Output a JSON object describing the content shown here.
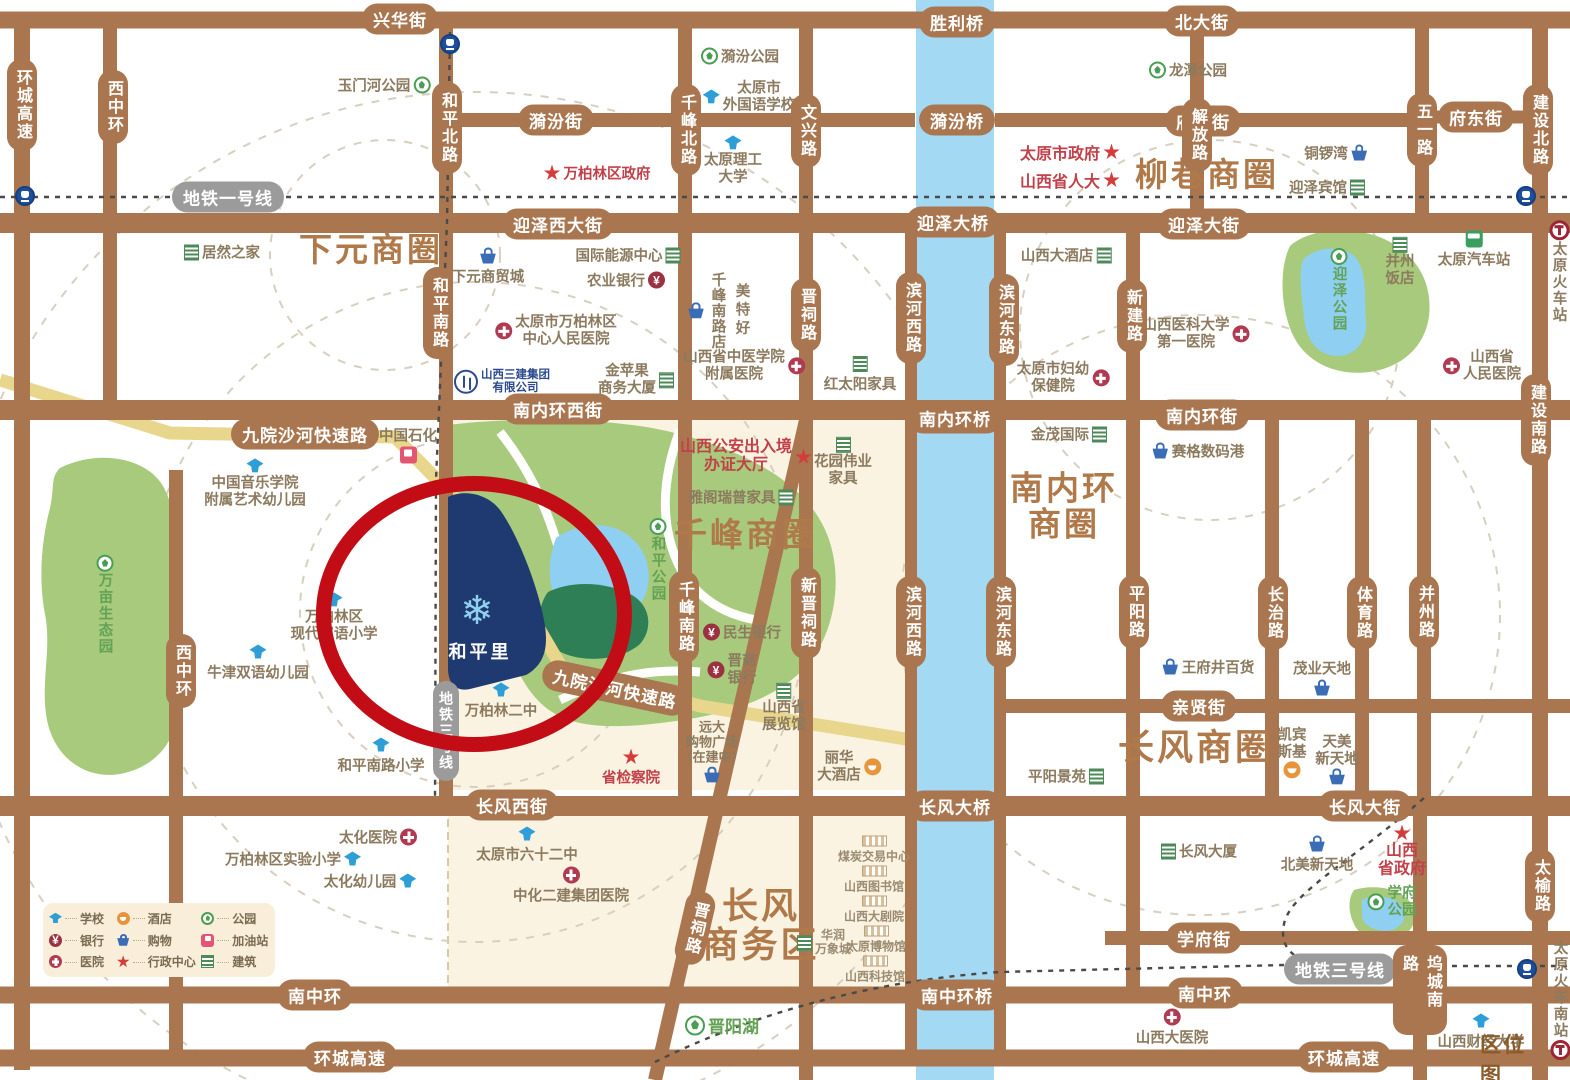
{
  "legend": {
    "items": [
      {
        "icon": "school",
        "label": "学校"
      },
      {
        "icon": "hotel",
        "label": "酒店"
      },
      {
        "icon": "park",
        "label": "公园"
      },
      {
        "icon": "bank",
        "label": "银行"
      },
      {
        "icon": "shop",
        "label": "购物"
      },
      {
        "icon": "gas",
        "label": "加油站"
      },
      {
        "icon": "hospital",
        "label": "医院"
      },
      {
        "icon": "admin",
        "label": "行政中心"
      },
      {
        "icon": "building",
        "label": "建筑"
      }
    ]
  },
  "metro": {
    "line1": "地铁一号线",
    "line3": "地铁三号线",
    "line3_b": "地铁三号线"
  },
  "districts": {
    "xiayuan": "下元商圈",
    "liuxiang": "柳巷商圈",
    "qianfeng": "千峰商圈",
    "nanneihuan_l1": "南内环",
    "nanneihuan_l2": "商圈",
    "changfeng": "长风商圈",
    "changfengbiz_l1": "长风",
    "changfengbiz_l2": "商务区"
  },
  "project": {
    "name": "和平里",
    "logo_icon": "snowflake"
  },
  "corner_tag": "区位图",
  "roads": {
    "xinghua": "兴华街",
    "shengli": "胜利桥",
    "beida": "北大街",
    "yifen": "漪汾街",
    "yifenqiao": "漪汾桥",
    "fuxi": "府西街",
    "fudong": "府东街",
    "yingze_w": "迎泽西大街",
    "yingzeqiao": "迎泽大桥",
    "yingze": "迎泽大街",
    "nnh_w": "南内环西街",
    "nnh_qiao": "南内环桥",
    "nnh": "南内环街",
    "cf_w": "长风西街",
    "cf_qiao": "长风大桥",
    "cf": "长风大街",
    "qinxian": "亲贤街",
    "xuefu": "学府街",
    "nzh_w": "南中环",
    "nzh_qiao": "南中环桥",
    "nzh_e": "南中环",
    "hc_sw": "环城高速",
    "hc_se": "环城高速",
    "hc_w": "环城高速",
    "xzh_n": "西中环",
    "xzh_s": "西中环",
    "hp_n": "和平北路",
    "hp_s": "和平南路",
    "qf_n": "千峰北路",
    "qf_s": "千峰南路",
    "wenxing": "文兴路",
    "jinci": "晋祠路",
    "jinci_d": "晋祠路",
    "xinjinci": "新晋祠路",
    "bhx_n": "滨河西路",
    "bhx_s": "滨河西路",
    "bhd_n": "滨河东路",
    "bhd_s": "滨河东路",
    "xinjian": "新建路",
    "jiefang": "解放路",
    "wuyi": "五一路",
    "js_n": "建设北路",
    "js_s": "建设南路",
    "pingyang": "平阳路",
    "changzhi": "长治路",
    "tiyu": "体育路",
    "bingzhou": "并州路",
    "wucheng": "坞城南路",
    "taiyu": "太榆路",
    "jiuyuan_a": "九院沙河快速路",
    "jiuyuan_b": "九院沙河快速路"
  },
  "pois": {
    "yumenhe": "玉门河公园",
    "juran": "居然之家",
    "xiayuan_mall": "下元商贸城",
    "wanbailin_gov": "万柏林区政府",
    "energy_center": "国际能源中心",
    "abc_bank": "农业银行",
    "center_hosp_l1": "太原市万柏林区",
    "center_hosp_l2": "中心人民医院",
    "goldapple_l1": "金苹果",
    "goldapple_l2": "商务大厦",
    "sanjian_l1": "山西三建集团",
    "sanjian_l2": "有限公司",
    "yifen_park": "漪汾公园",
    "foreign_l1": "太原市",
    "foreign_l2": "外国语学校",
    "tyut_l1": "太原理工",
    "tyut_l2": "大学",
    "sinopec": "中国石化",
    "music_kg_l1": "中国音乐学院",
    "music_kg_l2": "附属艺术幼儿园",
    "wanmu": "万亩生态园",
    "modern_l1": "万柏林区",
    "modern_l2": "现代双语小学",
    "oxford": "牛津双语幼儿园",
    "hpnl_primary": "和平南路小学",
    "wbl_no2": "万柏林二中",
    "taihua_hosp": "太化医院",
    "wbl_exp": "万柏林区实验小学",
    "taihua_kg": "太化幼儿园",
    "ty62": "太原市六十二中",
    "zhonghua_hosp": "中化二建集团医院",
    "procuratorate": "省检察院",
    "yuanda_l1": "远大",
    "yuanda_l2": "购物广场",
    "yuanda_l3": "（在建中）",
    "jinyang_lake": "晋阳湖",
    "coal_center": "煤炭交易中心",
    "sx_lib": "山西图书馆",
    "sx_theatre": "山西大剧院",
    "mixc_l1": "华润",
    "mixc_l2": "万象城",
    "ty_museum": "太原博物馆",
    "sx_tech": "山西科技馆",
    "lihua_l1": "丽华",
    "lihua_l2": "大酒店",
    "sx_expo_l1": "山西省",
    "sx_expo_l2": "展览馆",
    "minsheng": "民生银行",
    "jinshang_l1": "晋商",
    "jinshang_l2": "银行",
    "heping_park": "和平公园",
    "exit_entry_l1": "山西公安出入境",
    "exit_entry_l2": "办证大厅",
    "yage": "雅阁瑞普家具",
    "huayuan_l1": "花园伟业",
    "huayuan_l2": "家具",
    "redsun": "红太阳家具",
    "tcm_l1": "山西省中医学院",
    "tcm_l2": "附属医院",
    "meitehao": "美特好",
    "meitehao_branch": "千峰南路店",
    "longtan": "龙潭公园",
    "ty_gov": "太原市政府",
    "sx_npc": "山西省人大",
    "tongluowan": "铜锣湾",
    "yingze_hotel": "迎泽宾馆",
    "sx_grand_hotel": "山西大酒店",
    "med_l1": "山西医科大学",
    "med_l2": "第一医院",
    "yingze_park": "迎泽公园",
    "bingzhou_hotel_l1": "并州",
    "bingzhou_hotel_l2": "饭店",
    "ty_bus": "太原汽车站",
    "ty_rail": "太原火车站",
    "sx_people_hosp_l1": "山西省",
    "sx_people_hosp_l2": "人民医院",
    "fuyou_l1": "太原市妇幼",
    "fuyou_l2": "保健院",
    "jinmao": "金茂国际",
    "seg": "赛格数码港",
    "wangfujing": "王府井百货",
    "maoye": "茂业天地",
    "kempinski_l1": "凯宾",
    "kempinski_l2": "斯基",
    "tianmei_l1": "天美",
    "tianmei_l2": "新天地",
    "pyjy": "平阳景苑",
    "cf_tower": "长风大厦",
    "beimei": "北美新天地",
    "sx_gov_l1": "山西",
    "sx_gov_l2": "省政府",
    "xuefu_park_l1": "学府",
    "xuefu_park_l2": "公园",
    "sx_dayiyuan": "山西大医院",
    "sx_finance": "山西财经大学",
    "ty_south": "太原火车南站"
  }
}
